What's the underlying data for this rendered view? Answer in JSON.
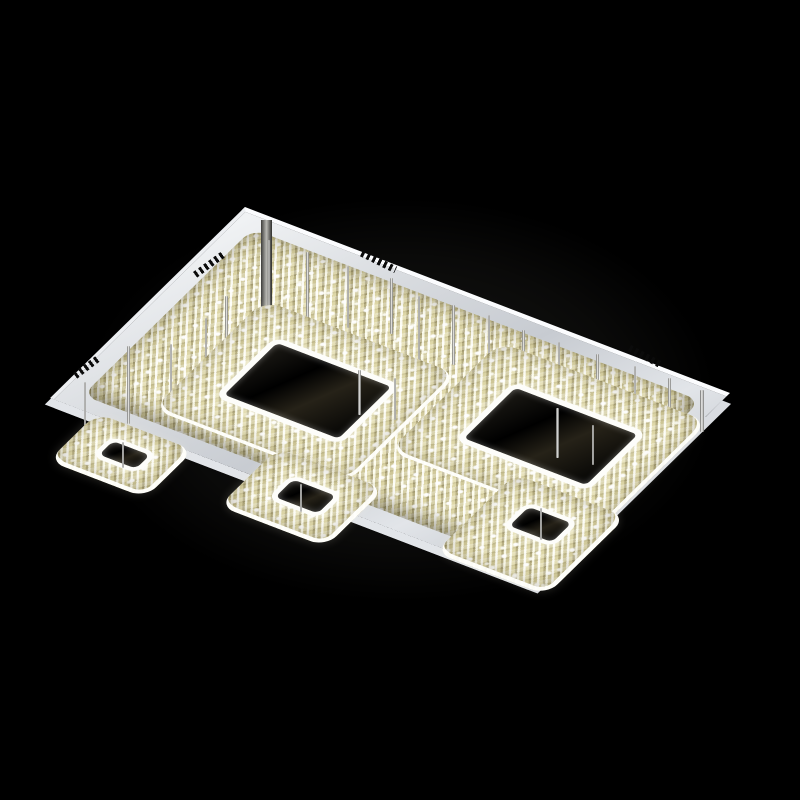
{
  "scene": {
    "type": "product-photograph",
    "subject": "Modern LED crystal flush-mount ceiling chandelier with square crystal rings",
    "background_color": "#000000",
    "view": "seen from below at an angle, fixture mounted to ceiling plate",
    "lighting": "warm-white LEDs glowing through champagne crystals"
  },
  "fixture": {
    "canopy_plate": {
      "shape": "rectangle in perspective",
      "finish": "polished chrome / stainless steel",
      "surface_color": "#d8dbdf",
      "rim_highlight_color": "#fbfcfe",
      "vent_slot_color": "#0b0b0b",
      "vent_groups": [
        {
          "position": "upper-left edge",
          "slots": 6
        },
        {
          "position": "upper-right edge near top corner",
          "slots": 6
        },
        {
          "position": "upper-right edge near right corner",
          "slots": 6
        },
        {
          "position": "lower-left edge near left corner",
          "slots": 6
        }
      ]
    },
    "perimeter_crystal_band": {
      "description": "band of faceted crystals covering the underside of the plate",
      "color_base": "#d9d3ab"
    },
    "rings": [
      {
        "id": "large-left",
        "tier": "upper",
        "size": "large",
        "hole": "large",
        "led_border": "#ffffff"
      },
      {
        "id": "large-right",
        "tier": "upper",
        "size": "large",
        "hole": "large",
        "led_border": "#ffffff"
      },
      {
        "id": "small-left",
        "tier": "lower",
        "size": "small",
        "hole": "small",
        "led_border": "#ffffff"
      },
      {
        "id": "small-center",
        "tier": "lower",
        "size": "small",
        "hole": "small",
        "led_border": "#ffffff"
      },
      {
        "id": "small-right",
        "tier": "lower",
        "size": "small",
        "hole": "small",
        "led_border": "#ffffff"
      }
    ],
    "crystal_palette": {
      "base": "#d9d3ab",
      "mid": "#e2dbaa",
      "highlight": "#ffffff",
      "shadow": "#8a8158",
      "led_strip": "#ffffff"
    },
    "support_rods": {
      "count": 26,
      "finish": "chrome"
    }
  }
}
